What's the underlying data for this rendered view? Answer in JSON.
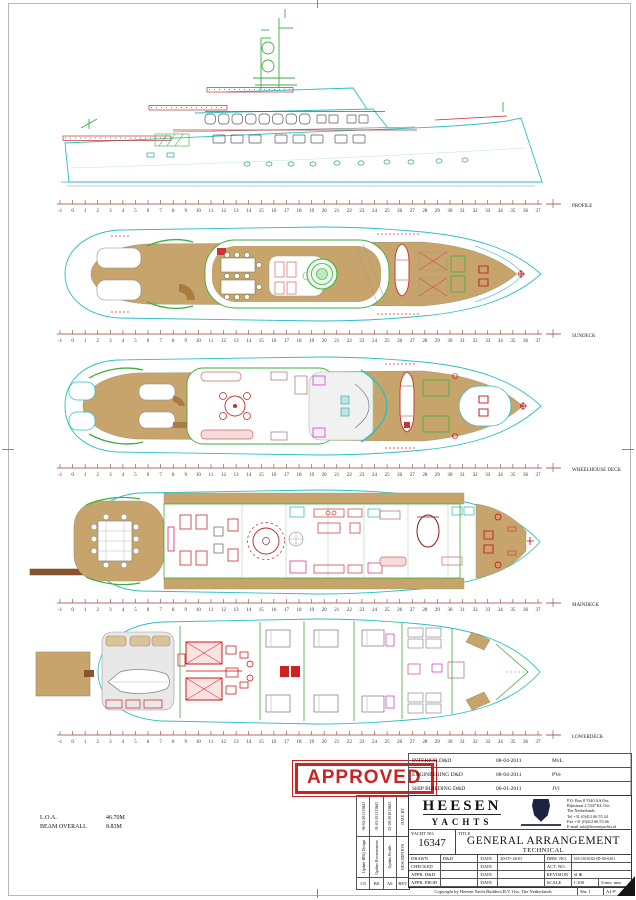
{
  "views": [
    {
      "label": "PROFILE"
    },
    {
      "label": "SUNDECK"
    },
    {
      "label": "WHEELHOUSE DECK"
    },
    {
      "label": "MAINDECK"
    },
    {
      "label": "LOWERDECK"
    }
  ],
  "ruler": {
    "start": -1,
    "end": 37,
    "line_color": "#9a4038",
    "num_color": "#333333"
  },
  "stamp": {
    "text": "APPROVED",
    "color": "#cc2222"
  },
  "dimensions": {
    "loa_label": "L.O.A.",
    "loa_value": "46.70M",
    "beam_label": "BEAM OVERALL",
    "beam_value": "8.83M"
  },
  "approvals": {
    "rows": [
      {
        "dept": "INTERIOR D&D",
        "date": "08-04-2011",
        "initials": "MvL"
      },
      {
        "dept": "ENGINEERING D&D",
        "date": "08-04-2011",
        "initials": "PVe"
      },
      {
        "dept": "SHIP BUILDING D&D",
        "date": "06-01-2011",
        "initials": "JVl"
      }
    ]
  },
  "revisions": {
    "header": {
      "date_by": "DATE   BY",
      "desc": "DESCRIPTION",
      "rev": "REV"
    },
    "entries": [
      {
        "date_by": "06-04-2011  D&D",
        "desc": "Update BBQ Design",
        "rev": "C0"
      },
      {
        "date_by": "01-03-2011  D&D",
        "desc": "Update Roommasters",
        "rev": "B0"
      },
      {
        "date_by": "22-09-2010  D&D",
        "desc": "Update Profile",
        "rev": "A0"
      }
    ]
  },
  "title_block": {
    "brand_line1": "HEESEN",
    "brand_line2": "YACHTS",
    "address": [
      "P.O. Box 8 5340 AA Oss",
      "Rijnstraat 2 5347 KL Oss",
      "The Netherlands",
      "Tel +31 (0)412 66 55 44",
      "Fax +31 (0)412 66 55 66",
      "E-mail info@heesenyachts.nl"
    ],
    "yacht_no_label": "YACHT NO.",
    "yacht_no": "16347",
    "title_label": "TITLE",
    "title_main": "GENERAL ARRANGEMENT",
    "title_sub": "TECHNICAL",
    "rows": [
      {
        "c1": "DRAWN",
        "c2": "D&D",
        "c3": "DATE",
        "c4": "20-07-2010",
        "c5": "DRW. NO.",
        "c6": "163-1010102-ID-00-0201"
      },
      {
        "c1": "CHECKED",
        "c2": "",
        "c3": "DATE",
        "c4": "",
        "c5": "ACT. NO.",
        "c6": ""
      },
      {
        "c1": "APPR. D&D",
        "c2": "",
        "c3": "DATE",
        "c4": "",
        "c5": "REVISION",
        "c6": "⊲ ⊕"
      },
      {
        "c1": "APPR. PROD",
        "c2": "",
        "c3": "DATE",
        "c4": "",
        "c5": "SCALE",
        "c6": "1:100",
        "c7": "Units: mm"
      }
    ],
    "copyright": "Copyright by Heesen Yacht Builders B.V. Oss, The Netherlands",
    "sheet_no": "Sht: 1",
    "size_code": "A1-P"
  },
  "colors": {
    "hull_cyan": "#2bbfbf",
    "teak_tan": "#c7a46b",
    "trim_green": "#3fae3f",
    "furniture_red": "#c03030",
    "ruler_red": "#9a4038",
    "stamp_red": "#cc2222"
  }
}
